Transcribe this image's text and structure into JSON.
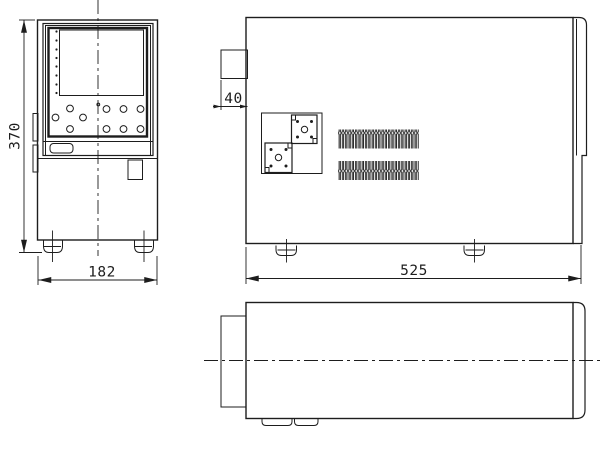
{
  "drawing": {
    "background": "#ffffff",
    "line_color": "#1d1d1d",
    "views": {
      "front": {
        "height_label": "370",
        "width_label": "182"
      },
      "side": {
        "bezel_depth_label": "40",
        "depth_label": "525"
      }
    }
  }
}
